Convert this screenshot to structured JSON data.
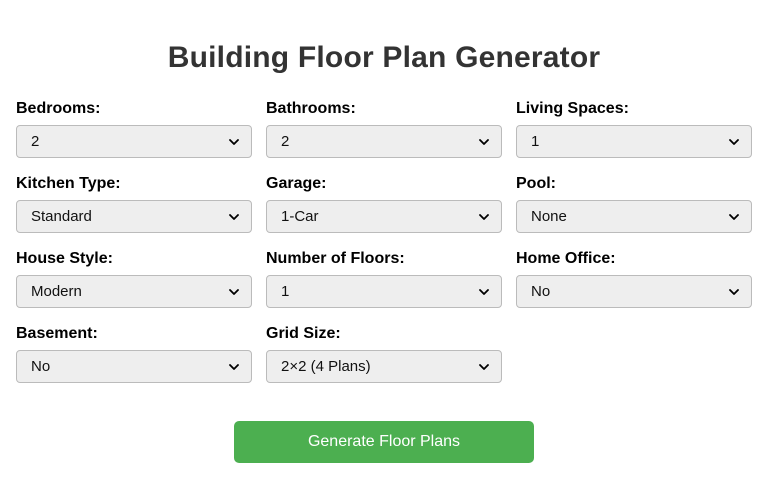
{
  "title": "Building Floor Plan Generator",
  "form": {
    "fields": [
      {
        "id": "bedrooms",
        "label": "Bedrooms:",
        "value": "2"
      },
      {
        "id": "bathrooms",
        "label": "Bathrooms:",
        "value": "2"
      },
      {
        "id": "living-spaces",
        "label": "Living Spaces:",
        "value": "1"
      },
      {
        "id": "kitchen-type",
        "label": "Kitchen Type:",
        "value": "Standard"
      },
      {
        "id": "garage",
        "label": "Garage:",
        "value": "1-Car"
      },
      {
        "id": "pool",
        "label": "Pool:",
        "value": "None"
      },
      {
        "id": "house-style",
        "label": "House Style:",
        "value": "Modern"
      },
      {
        "id": "number-of-floors",
        "label": "Number of Floors:",
        "value": "1"
      },
      {
        "id": "home-office",
        "label": "Home Office:",
        "value": "No"
      },
      {
        "id": "basement",
        "label": "Basement:",
        "value": "No"
      },
      {
        "id": "grid-size",
        "label": "Grid Size:",
        "value": "2×2 (4 Plans)"
      }
    ],
    "generate_button_label": "Generate Floor Plans"
  },
  "icons": [
    {
      "name": "chevron-down-icon",
      "meaning": "dropdown expand arrow"
    }
  ],
  "colors": {
    "page_background": "#ffffff",
    "title_text": "#333333",
    "label_text": "#000000",
    "select_background": "#eeeeee",
    "select_border": "#bbbbbb",
    "select_text": "#111111",
    "button_background": "#4CAF50",
    "button_text": "#ffffff"
  }
}
